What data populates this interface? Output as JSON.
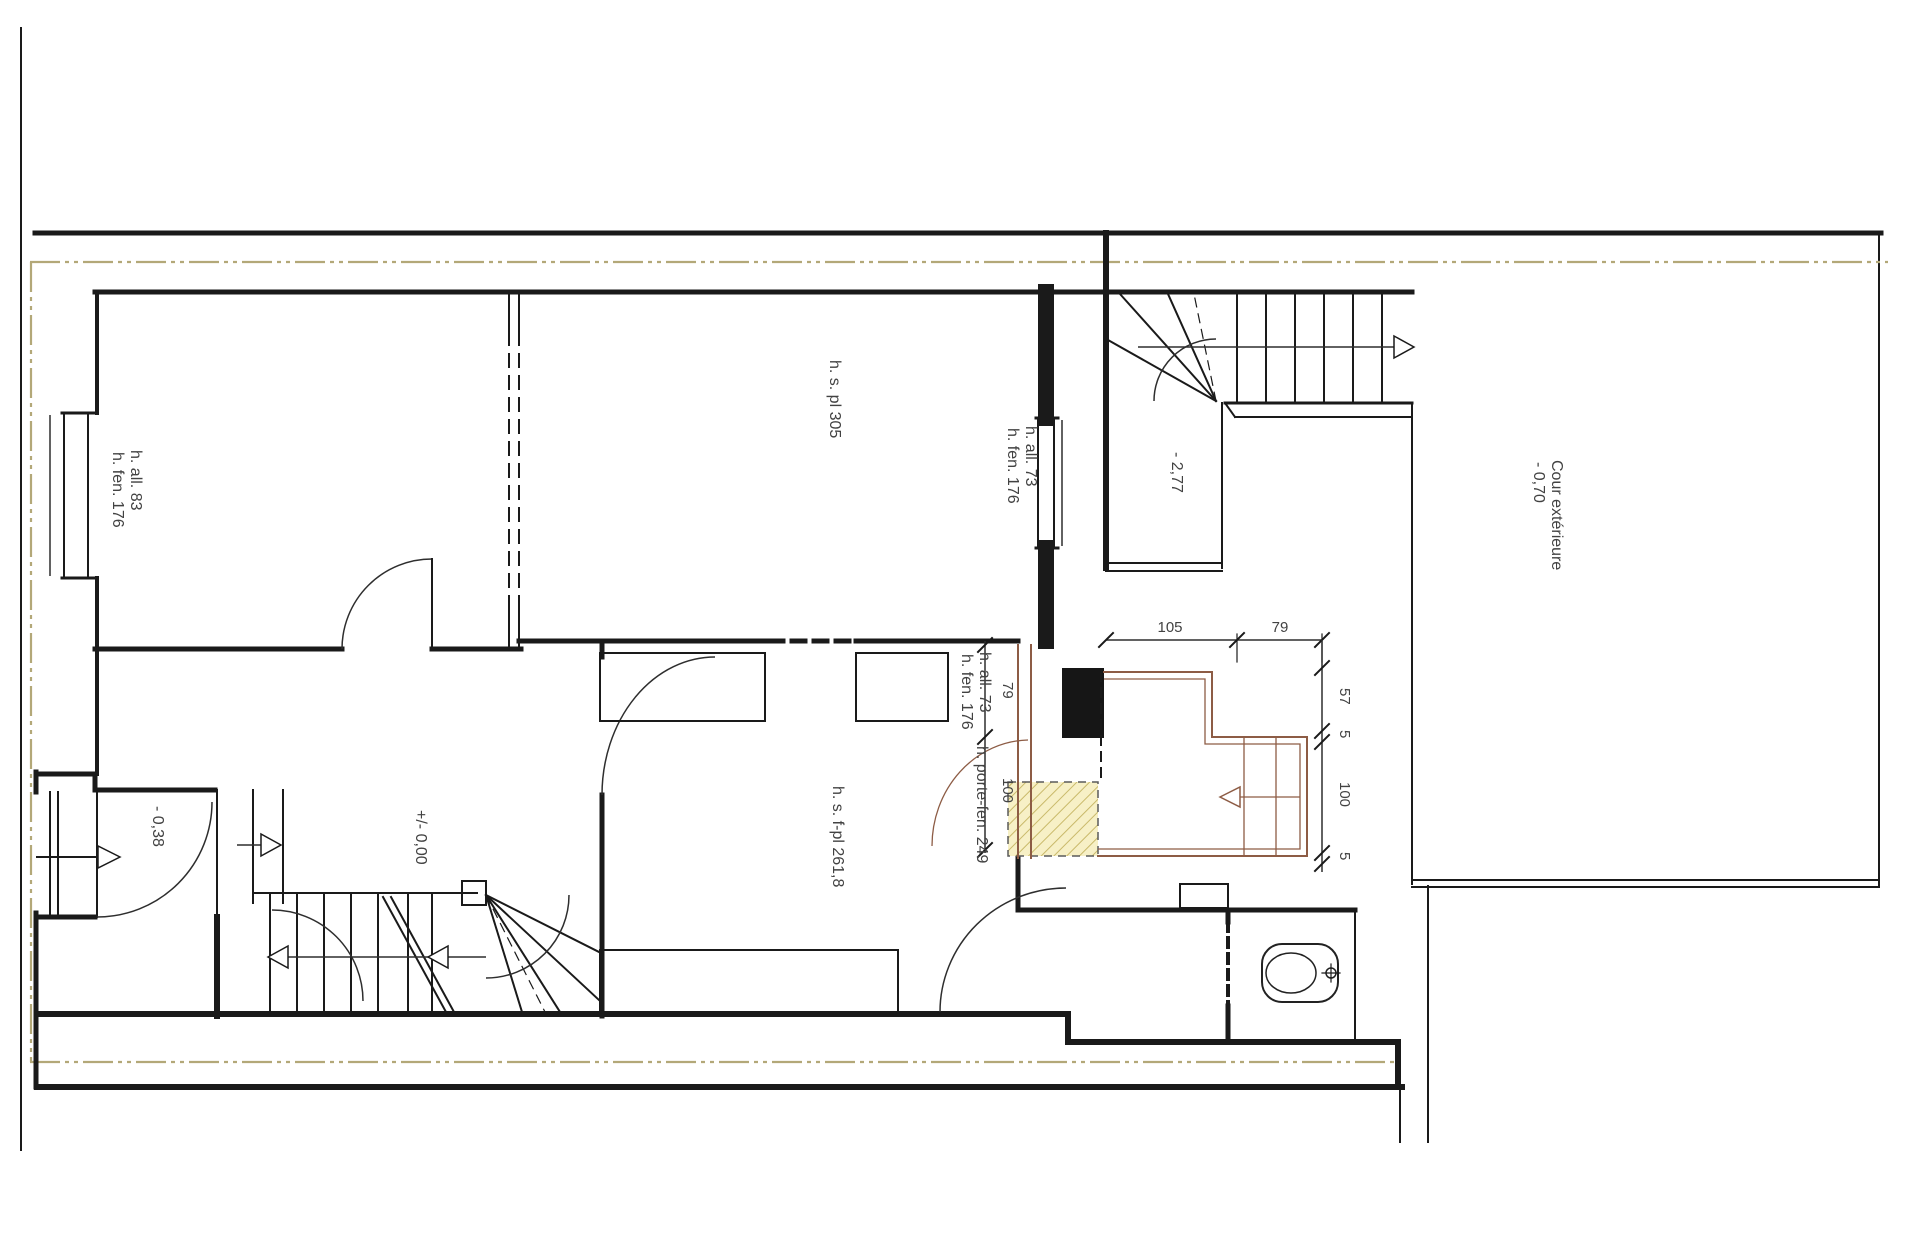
{
  "drawing": {
    "rooms": {
      "room1_window": {
        "l1": "h. all. 83",
        "l2": "h. fen. 176"
      },
      "room2": {
        "height": "h. s. pl 305",
        "window_l1": "h. all. 73",
        "window_l2": "h. fen. 176"
      },
      "stairwell_level": "- 2,77",
      "courtyard": {
        "name": "Cour extérieure",
        "level": "- 0,70"
      },
      "kitchen": {
        "height": "h. s. f-pl 261,8",
        "window_l1": "h. all. 73",
        "window_l2": "h. fen. 176",
        "porte_fenetre": "h. porte-fen. 249"
      },
      "entry_level": "- 0,38",
      "hall_level": "+/- 0,00"
    },
    "dimensions": {
      "w105": "105",
      "w79": "79",
      "w57": "57",
      "w5a": "5",
      "w100": "100",
      "w5b": "5",
      "bay79": "79",
      "bay100": "100"
    },
    "colors": {
      "wall": "#1a1a1a",
      "new_work": "#8d5c45",
      "boundary_axis": "#b3a878",
      "hatch_fill": "#f7f0c6",
      "hatch_stroke": "#c9b96a",
      "label_text": "#424242"
    }
  }
}
